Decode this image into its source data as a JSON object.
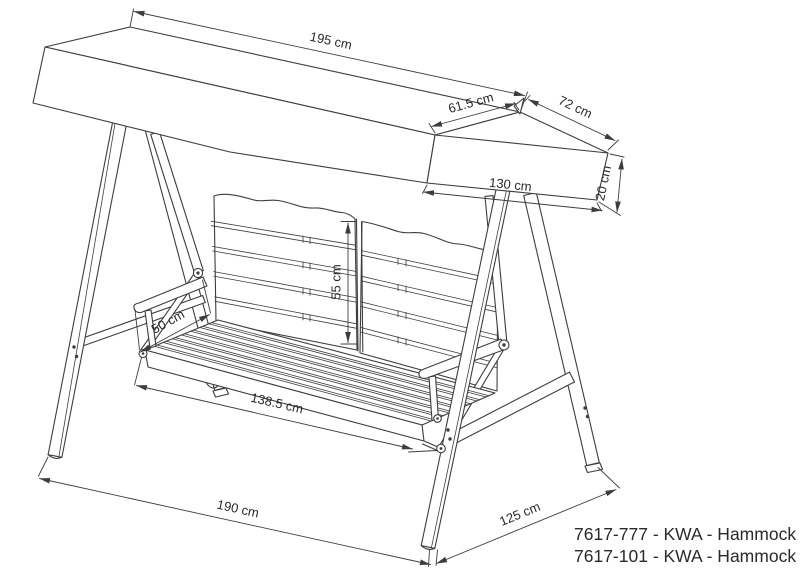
{
  "drawing": {
    "type": "technical-line-drawing",
    "subject": "canopy hammock swing",
    "colors": {
      "background": "#ffffff",
      "line": "#3d3d3d",
      "text": "#2a2a2a"
    },
    "dims": {
      "canopy_length": "195 cm",
      "canopy_slope_front": "61.5 cm",
      "canopy_slope_back": "72 cm",
      "canopy_depth": "130 cm",
      "canopy_thickness": "20 cm",
      "backrest_height": "55 cm",
      "armrest_depth": "50 cm",
      "seat_width": "138.5 cm",
      "base_width": "190 cm",
      "base_depth": "125 cm"
    },
    "product_codes": [
      "7617-777 - KWA - Hammock",
      "7617-101 - KWA - Hammock"
    ]
  }
}
